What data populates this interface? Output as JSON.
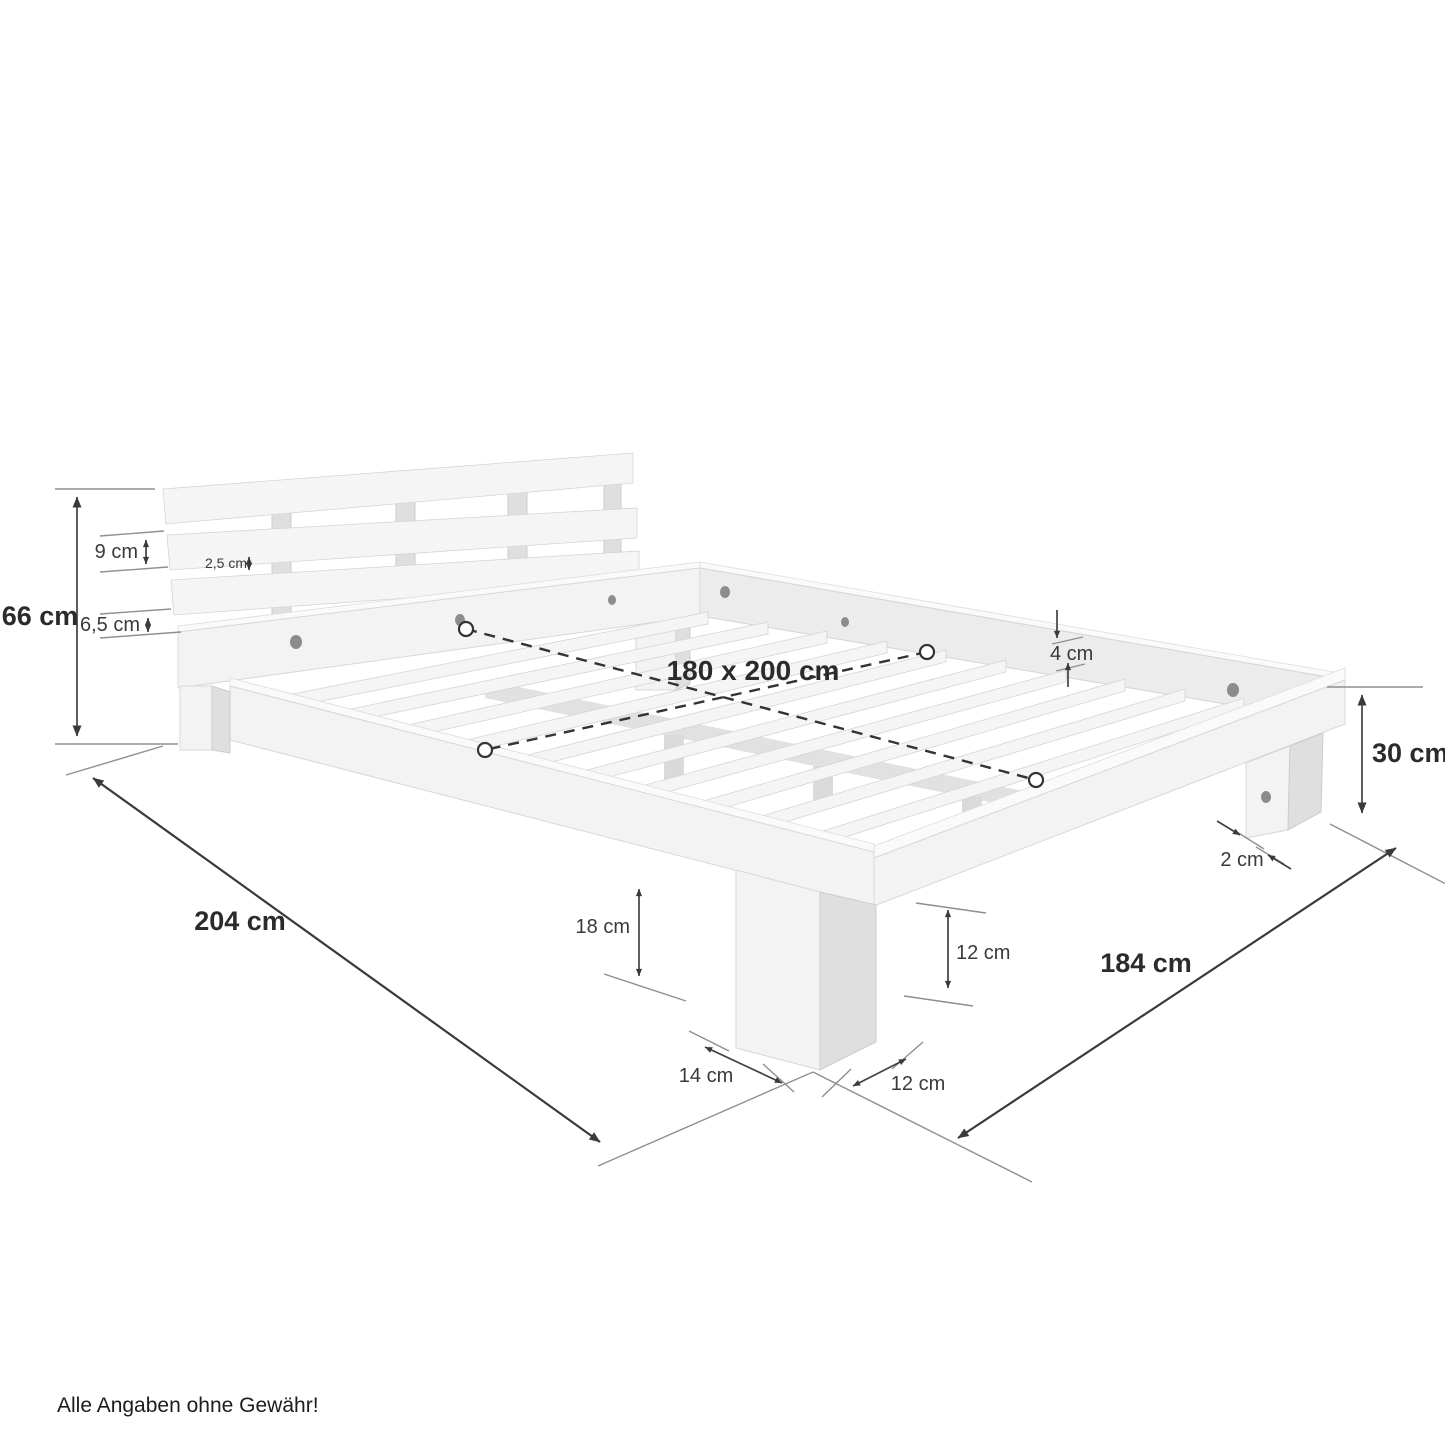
{
  "diagram": {
    "title": "bed-frame-dimension-diagram",
    "labels": {
      "d66": "66 cm",
      "d9": "9 cm",
      "d25": "2,5 cm",
      "d65": "6,5 cm",
      "d180": "180 x 200 cm",
      "d4": "4 cm",
      "d30": "30 cm",
      "d2": "2 cm",
      "d204": "204 cm",
      "d18": "18 cm",
      "d12v": "12 cm",
      "d14": "14 cm",
      "d12g": "12 cm",
      "d184": "184 cm"
    },
    "measurements": [
      {
        "dimension": "headboard-total-height",
        "text": "66 cm",
        "value_cm": 66
      },
      {
        "dimension": "headboard-board-height",
        "text": "9 cm",
        "value_cm": 9
      },
      {
        "dimension": "headboard-board-gap",
        "text": "2,5 cm",
        "value_cm": 2.5
      },
      {
        "dimension": "headboard-bottom-gap",
        "text": "6,5 cm",
        "value_cm": 6.5
      },
      {
        "dimension": "mattress-area",
        "text": "180 x 200 cm",
        "width_cm": 180,
        "length_cm": 200
      },
      {
        "dimension": "slat-thickness",
        "text": "4 cm",
        "value_cm": 4
      },
      {
        "dimension": "frame-height",
        "text": "30 cm",
        "value_cm": 30
      },
      {
        "dimension": "leg-inset",
        "text": "2 cm",
        "value_cm": 2
      },
      {
        "dimension": "total-length",
        "text": "204 cm",
        "value_cm": 204
      },
      {
        "dimension": "underbed-clearance",
        "text": "18 cm",
        "value_cm": 18
      },
      {
        "dimension": "leg-height",
        "text": "12 cm",
        "value_cm": 12
      },
      {
        "dimension": "leg-depth",
        "text": "14 cm",
        "value_cm": 14
      },
      {
        "dimension": "leg-width",
        "text": "12 cm",
        "value_cm": 12
      },
      {
        "dimension": "total-width",
        "text": "184 cm",
        "value_cm": 184
      }
    ],
    "footer": "Alle Angaben ohne Gewähr!",
    "colors": {
      "background": "#ffffff",
      "annotation": "#3a3a3a",
      "ground_line": "#8f8f8f",
      "wood_light": "#f3f3f3",
      "wood_shadow": "#dfdfdf"
    }
  }
}
